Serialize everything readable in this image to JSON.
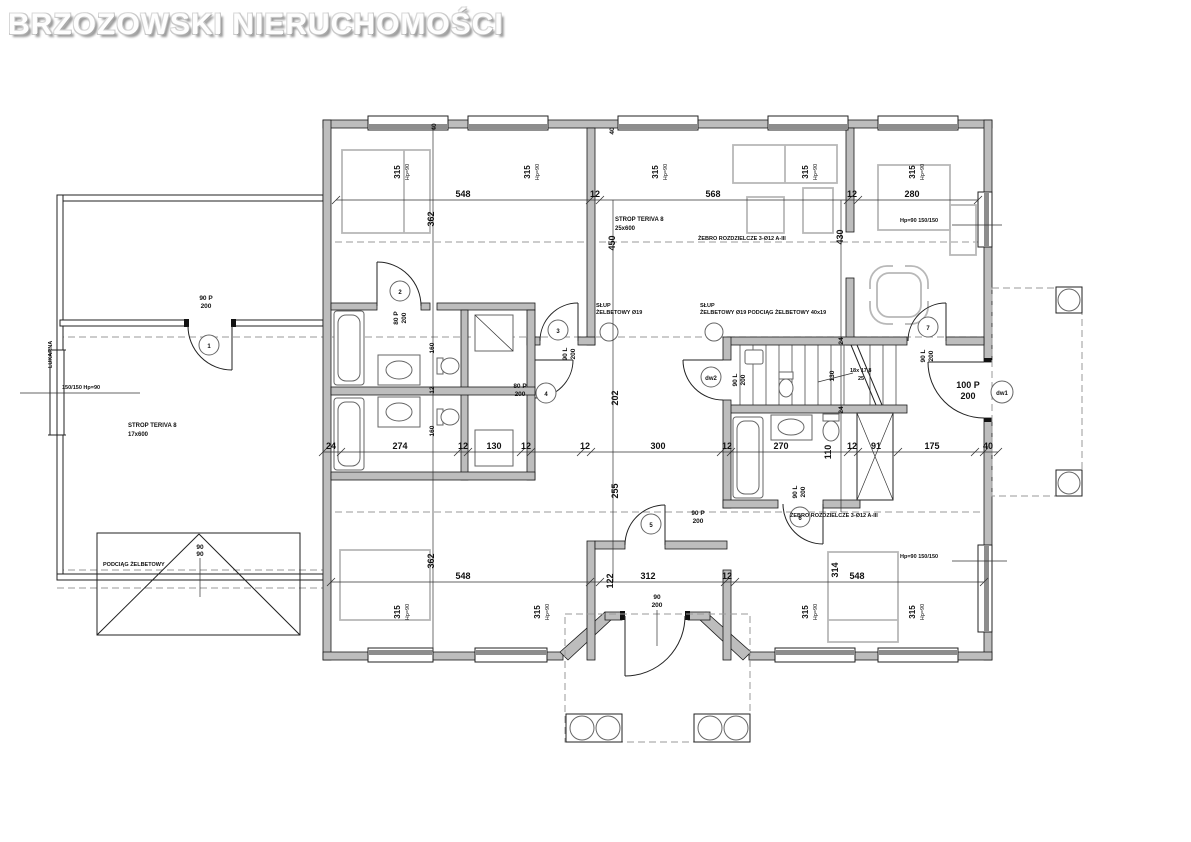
{
  "brand": "BRZOZOWSKI NIERUCHOMOŚCI",
  "annotations": {
    "strop_terrace_line1": "STROP TERIVA 8",
    "strop_terrace_line2": "17x600",
    "strop_living_line1": "STROP TERIVA 8",
    "strop_living_line2": "25x600",
    "zebro_top": "ŻEBRO ROZDZIELCZE 3-Ø12 A-III",
    "zebro_bottom": "ŻEBRO ROZDZIELCZE 3-Ø12 A-III",
    "slup_left_line1": "SŁUP",
    "slup_left_line2": "ŻELBETOWY Ø19",
    "slup_right_line1": "SŁUP",
    "slup_right_line2": "ŻELBETOWY Ø19   PODCIĄG ŻELBETOWY 40x19",
    "podciag_roof": "PODCIĄG ŻELBETOWY",
    "lukarna": "LUKARNA",
    "stairs_line1": "18x 17,8",
    "stairs_line2": "25",
    "roof_dim_line1": "90",
    "roof_dim_line2": "90",
    "entry_dim_line1": "90",
    "entry_dim_line2": "200"
  },
  "windows": {
    "w315": "315",
    "hp": "Hp=90",
    "left_label": "150/150 Hp=90",
    "right_label_top": "Hp=90 150/150",
    "right_label_bottom": "Hp=90 150/150"
  },
  "doors": [
    {
      "size": "90 P",
      "height": "200",
      "tag": "1"
    },
    {
      "size": "80 P",
      "height": "200",
      "tag": "2"
    },
    {
      "size": "90 L",
      "height": "200",
      "tag": "3"
    },
    {
      "size": "80 P",
      "height": "200",
      "tag": "4"
    },
    {
      "size": "90 L",
      "height": "200",
      "tag": "dw2"
    },
    {
      "size": "90 P",
      "height": "200",
      "tag": "5"
    },
    {
      "size": "90 L",
      "height": "200",
      "tag": "6"
    },
    {
      "size": "90 L",
      "height": "200",
      "tag": "7"
    },
    {
      "size": "100 P",
      "height": "200",
      "tag": "dw1"
    }
  ],
  "dims": {
    "top": [
      "548",
      "12",
      "568",
      "12",
      "280"
    ],
    "mid": [
      "24",
      "274",
      "12",
      "130",
      "12",
      "12",
      "300",
      "12",
      "270",
      "110",
      "12",
      "91",
      "175",
      "40"
    ],
    "bottom": [
      "548",
      "122",
      "312",
      "12",
      "314",
      "548"
    ],
    "vert": [
      "40",
      "40",
      "362",
      "450",
      "430",
      "160",
      "12",
      "160",
      "202",
      "255",
      "130",
      "24",
      "24",
      "362"
    ]
  }
}
